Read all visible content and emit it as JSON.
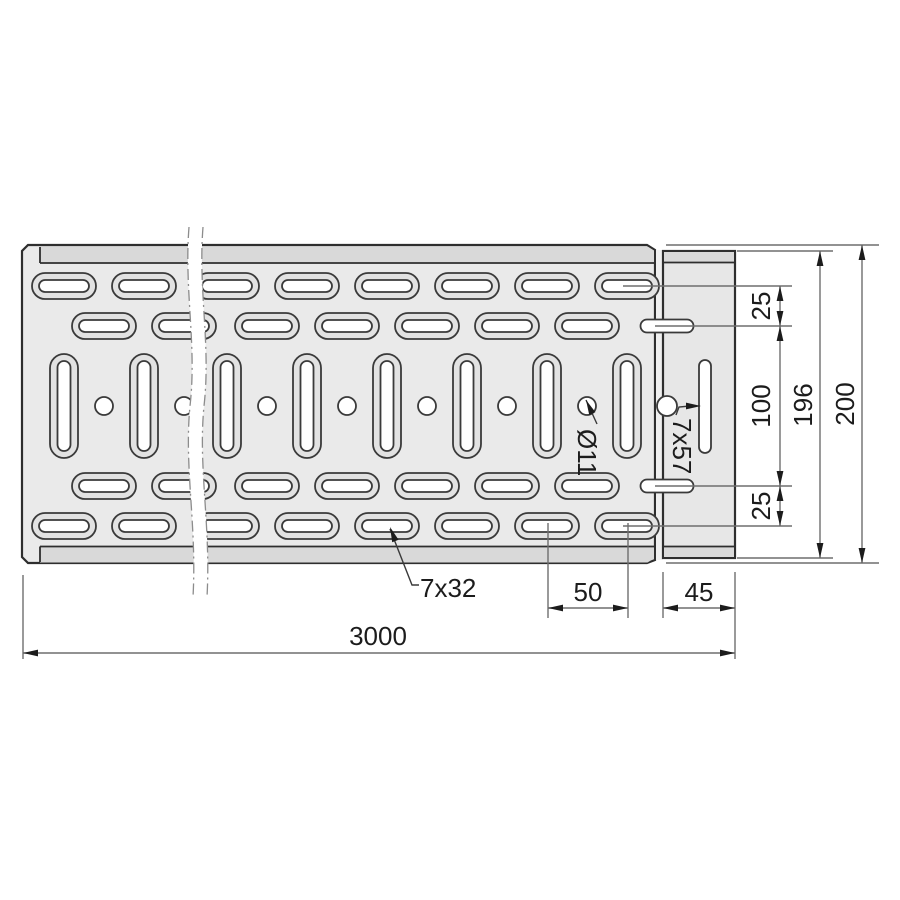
{
  "drawing": {
    "dimensions": {
      "overall_length": "3000",
      "slot_pitch": "50",
      "end_section": "45",
      "top_margin": "25",
      "middle_span": "100",
      "bottom_margin": "25",
      "inner_height": "196",
      "outer_height": "200"
    },
    "labels": {
      "oblong_slot": "7x32",
      "long_slot": "7x57",
      "round_hole": "Ø11"
    },
    "colors": {
      "plate_fill": "#eaeaea",
      "flange_band_fill": "#d9d9d9",
      "slot_ring_fill": "#e2e2e2",
      "hole_fill": "#ffffff",
      "outline": "#2e2e2e",
      "dimension_line": "#6e6e6e",
      "text": "#1c1c1c",
      "background": "#ffffff"
    }
  }
}
